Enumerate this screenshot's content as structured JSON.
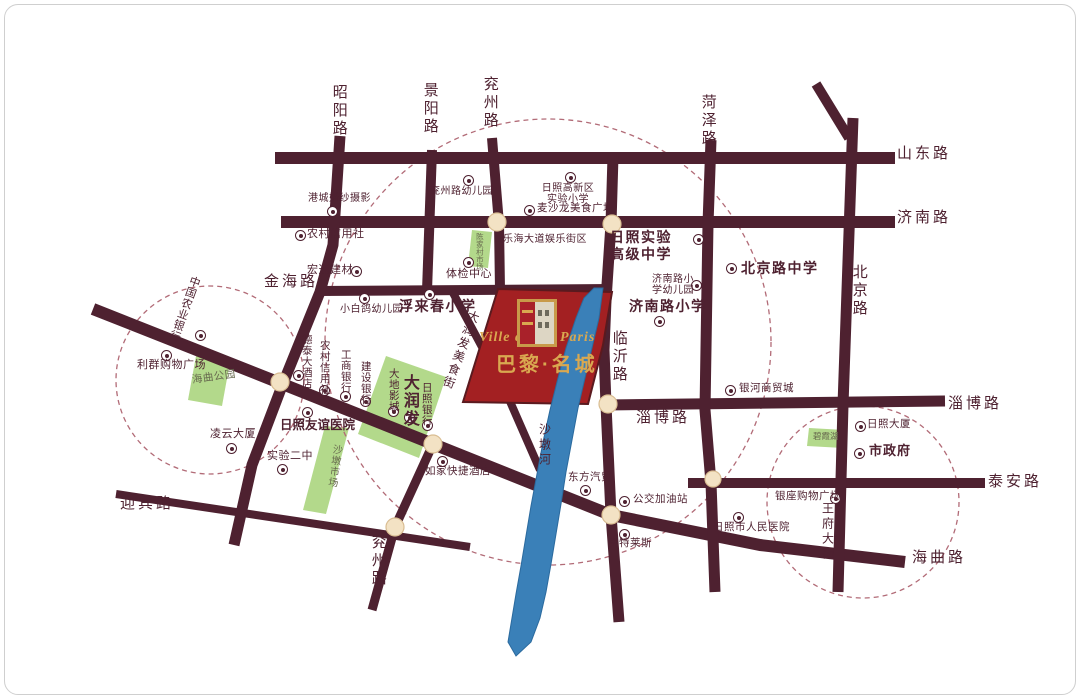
{
  "property": {
    "name_en_left": "Ville de",
    "name_en_right": "Paris",
    "name_cn": "巴黎·名城"
  },
  "road_labels": {
    "zhaoyang": "昭阳路",
    "jingyang": "景阳路",
    "yanzhou_top": "兖州路",
    "heze": "菏泽路",
    "shandong": "山东路",
    "jinan": "济南路",
    "beijing": "北京路",
    "jinhai": "金海路",
    "linyi": "临沂路",
    "zibo_mid": "淄博路",
    "zibo_right": "淄博路",
    "taian": "泰安路",
    "haiqu": "海曲路",
    "yingbin": "迎宾路",
    "yanzhou_bottom": "兖州路",
    "wangfu": "王府大街"
  },
  "river_label": "沙墩河",
  "pois": {
    "kindergarten_yanzhou": "兖州路幼儿园",
    "wedding_photo": "港城婚纱摄影",
    "credit_union_n": "农村信用社",
    "hongtong_materials": "宏通建材",
    "physical_exam": "体检中心",
    "gaoxin_primary": {
      "line1": "日照高新区",
      "line2": "实验小学"
    },
    "maishalong": "麦沙龙美食广场",
    "lehai": "乐海大道娱乐街区",
    "rizhao_exp_high": {
      "line1": "日照实验",
      "line2": "高级中学"
    },
    "jinan_rd_kg": {
      "line1": "济南路小",
      "line2": "学幼儿园"
    },
    "jinan_rd_primary": "济南路小学",
    "beijing_rd_middle": "北京路中学",
    "xiaobaige": "小白鸽幼儿园",
    "fulaichun": "浮来春小学",
    "abc_bank": "中国农业银行",
    "liqun_plaza": "利群购物广场",
    "lingyun": "凌云大厦",
    "no2_middle": "实验二中",
    "friendship_hospital": "日照友谊医院",
    "detai_hotel": "德泰大酒店",
    "credit_union_s": "农村信用社",
    "icbc": "工商银行",
    "ccb": "建设银行",
    "dadi_cinema": "大地影城",
    "darunfa": "大润发",
    "rizhao_bank": "日照银行",
    "rujia_hotel": "如家快捷酒店",
    "dongfang_auto": "东方汽贸",
    "bus_gas_station": "公交加油站",
    "outlets": "奥特莱斯",
    "yinhe_mall": "银河商贸城",
    "rizhao_tower": "日照大厦",
    "city_gov": "市政府",
    "yinzuo_plaza": "银座购物广场",
    "people_hospital": "日照市人民医院",
    "food_street": "大润发美食街"
  },
  "areas": {
    "haiqu_park": "海曲公园",
    "chenjiacun_market": "陈家村市场",
    "shadun_market": "沙墩市场",
    "bixia_lake": "碧霞湖"
  },
  "colors": {
    "road": "#4e2130",
    "label": "#4e2130",
    "parcel_red": "#a32022",
    "brand_gold": "#d9a850",
    "green_area": "#b3d98b",
    "river_blue": "#3a80b8",
    "dashed_ring": "#b26b77",
    "roundabout": "#f3e2c4"
  }
}
